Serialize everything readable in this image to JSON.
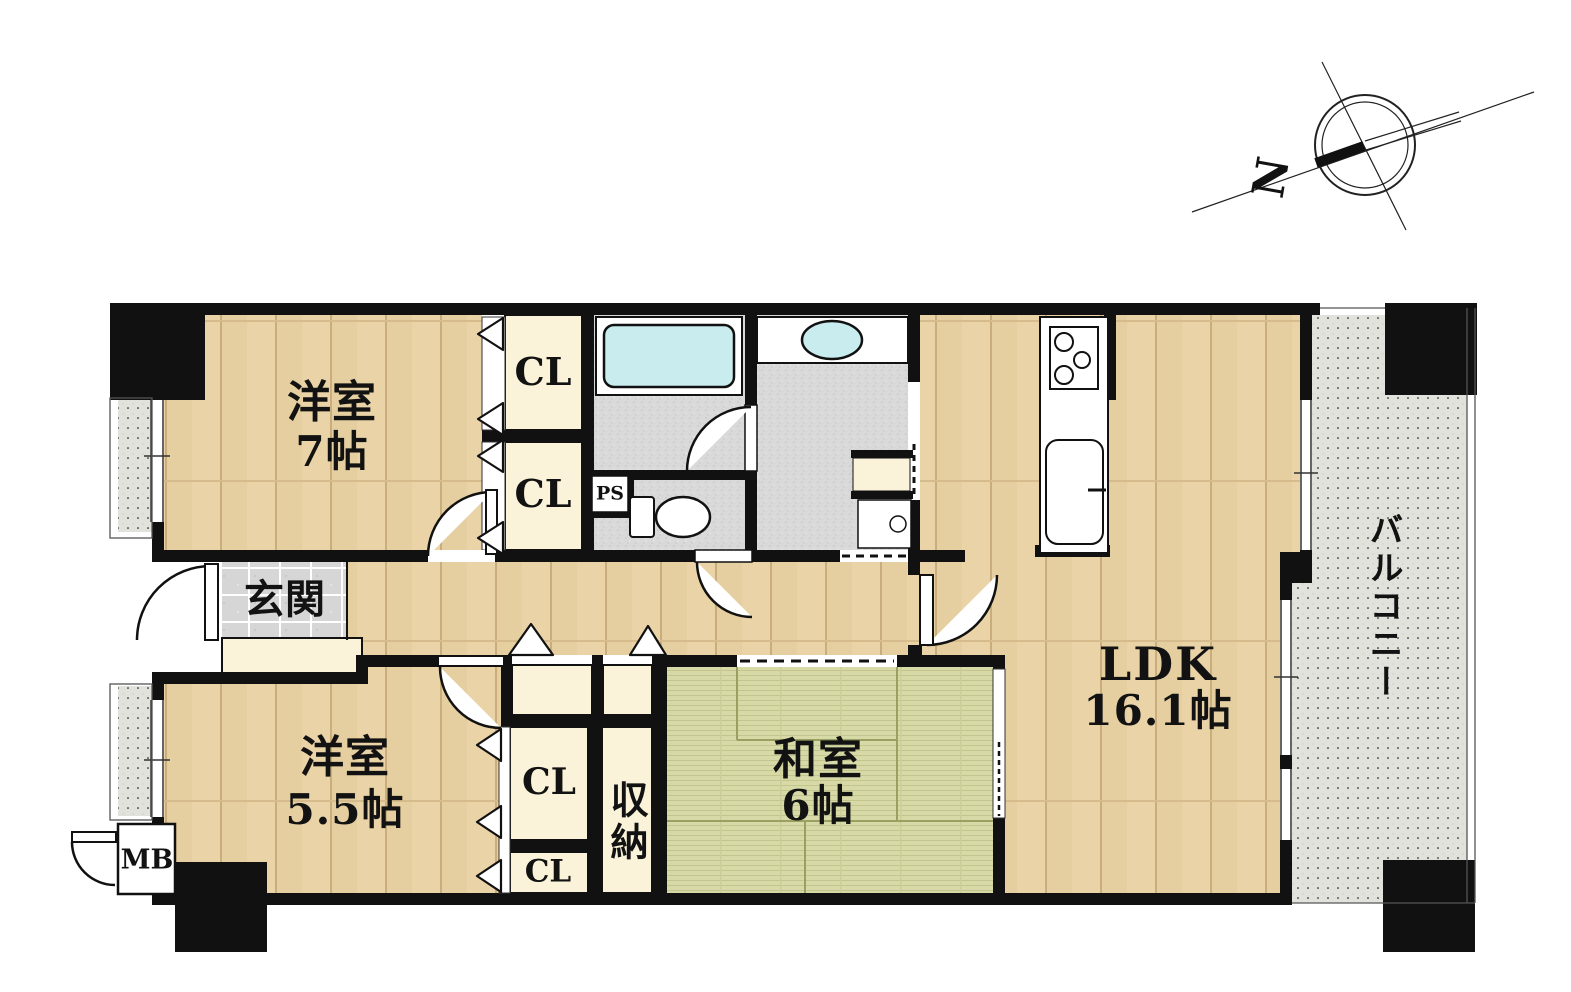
{
  "plan": {
    "compass": {
      "north": "N"
    },
    "rooms": {
      "western7": {
        "name": "洋室",
        "size": "7帖"
      },
      "western55": {
        "name": "洋室",
        "size": "5.5帖"
      },
      "japanese6": {
        "name": "和室",
        "size": "6帖"
      },
      "ldk": {
        "name": "LDK",
        "size": "16.1帖"
      },
      "entrance": {
        "name": "玄関"
      },
      "storage": {
        "name": "収納"
      },
      "balcony": {
        "name": "バルコニー"
      }
    },
    "closets": {
      "cl1": "CL",
      "cl2": "CL",
      "cl3": "CL",
      "cl4": "CL"
    },
    "utilities": {
      "pipe_space": "PS",
      "meter_box": "MB"
    },
    "colors": {
      "wall": "#111111",
      "wood_floor": "#e8d2a6",
      "tatami": "#d6d8a6",
      "closet_cream": "#faf3d9",
      "wet_tile": "#d9d9d9",
      "water_fixture": "#c9ecef",
      "balcony_floor": "#e2e2dc"
    }
  }
}
